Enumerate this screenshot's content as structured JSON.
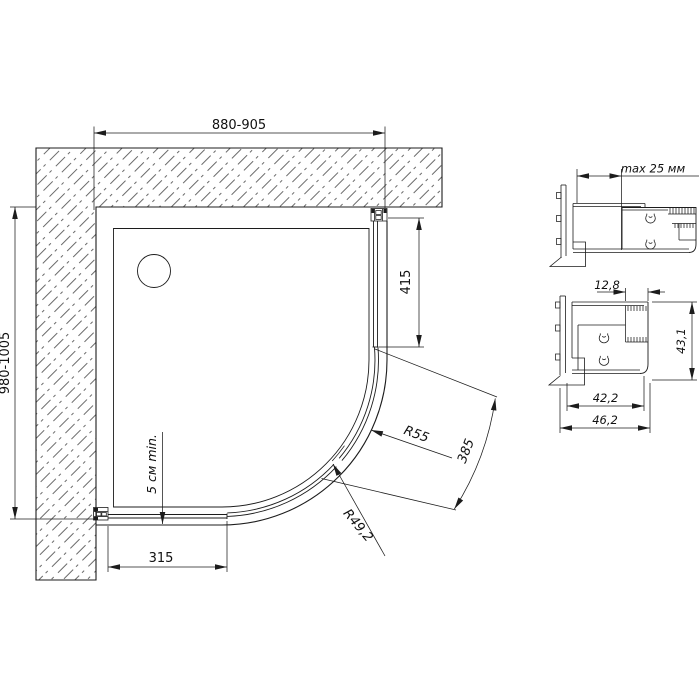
{
  "page": {
    "background": "#ffffff",
    "line_color": "#1c1c1c"
  },
  "plan_view": {
    "dim_width": "880-905",
    "dim_depth": "980-1005",
    "dim_side_fixed_panel": "415",
    "dim_front_fixed_panel": "315",
    "dim_door_opening_arc": "385",
    "radius_outer_label": "R55",
    "radius_inner_label": "R49,2",
    "clearance_note": "5 см min."
  },
  "profile_detail_top": {
    "dim_adjustment": "max 25 мм"
  },
  "profile_detail_bottom": {
    "dim_glass_slot": "12,8",
    "dim_height": "43,1",
    "dim_inner_width": "42,2",
    "dim_outer_width": "46,2"
  }
}
